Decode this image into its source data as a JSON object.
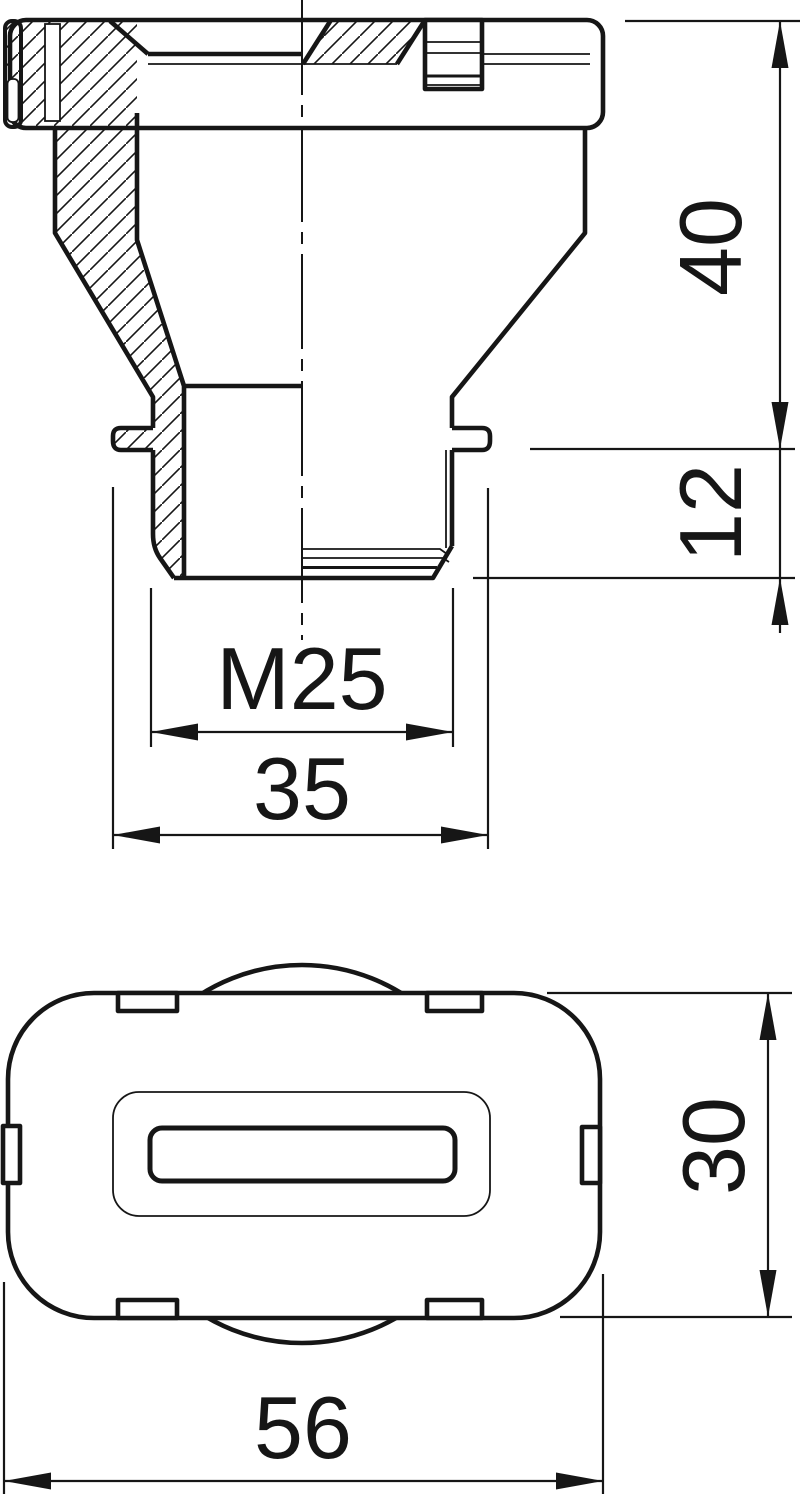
{
  "drawing": {
    "background_color": "#ffffff",
    "line_color": "#161616",
    "views": {
      "side_section": {
        "dims": {
          "upper_height": "40",
          "thread_length": "12",
          "thread_size": "M25",
          "flange_width": "35"
        }
      },
      "plan": {
        "dims": {
          "body_height": "30",
          "body_width": "56"
        }
      }
    }
  }
}
